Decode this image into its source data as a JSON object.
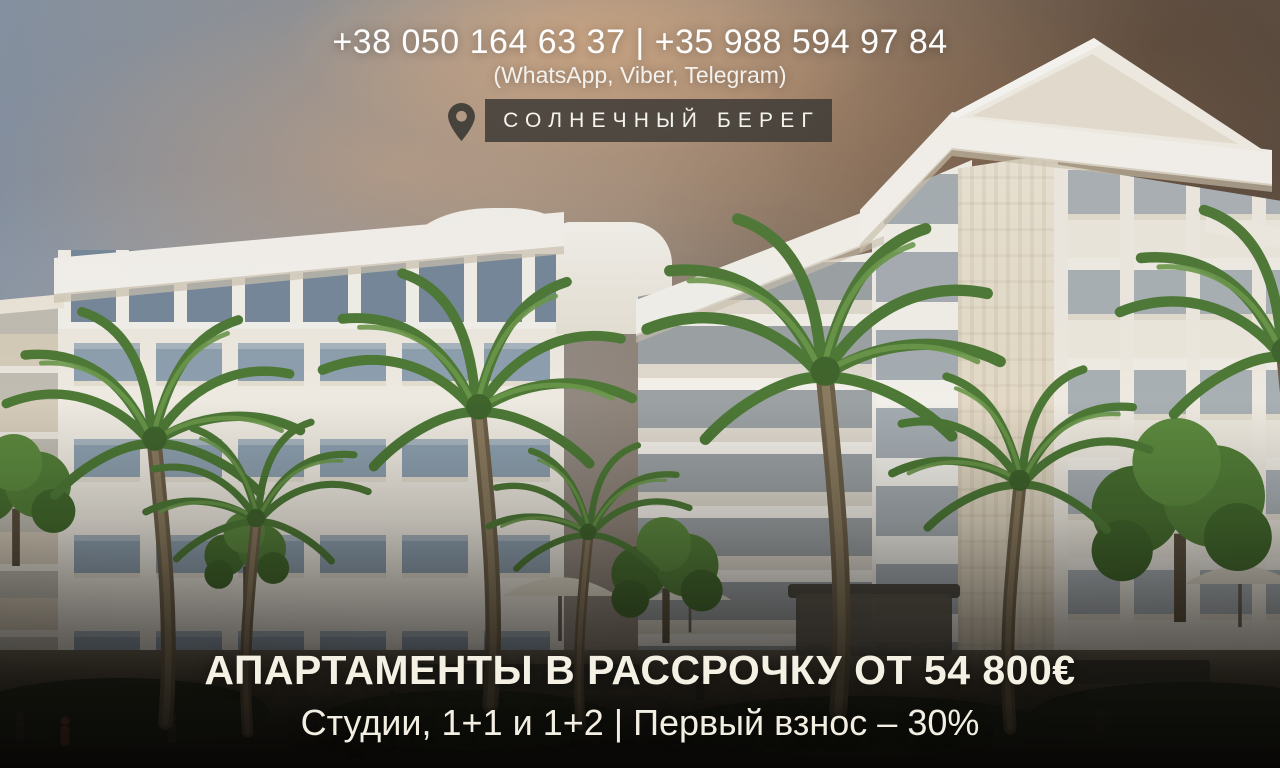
{
  "contact": {
    "phones": "+38 050 164 63 37 | +35 988 594 97 84",
    "messengers": "(WhatsApp, Viber, Telegram)"
  },
  "location": {
    "icon": "location-pin-icon",
    "label": "СОЛНЕЧНЫЙ БЕРЕГ"
  },
  "offer": {
    "headline": "АПАРТАМЕНТЫ В РАССРОЧКУ ОТ 54 800€",
    "subline": "Студии, 1+1 и 1+2 | Первый взнос – 30%"
  },
  "colors": {
    "badge_bg": "#3f3b37",
    "text_cream": "#f4f0e4",
    "sky_blue": "#8290a3",
    "cloud_orange": "#d3a077",
    "sky_brown": "#5f4f41",
    "building_cream": "#f1ece1",
    "palm_green": "#4d7a36",
    "ground_dark": "#161310"
  }
}
